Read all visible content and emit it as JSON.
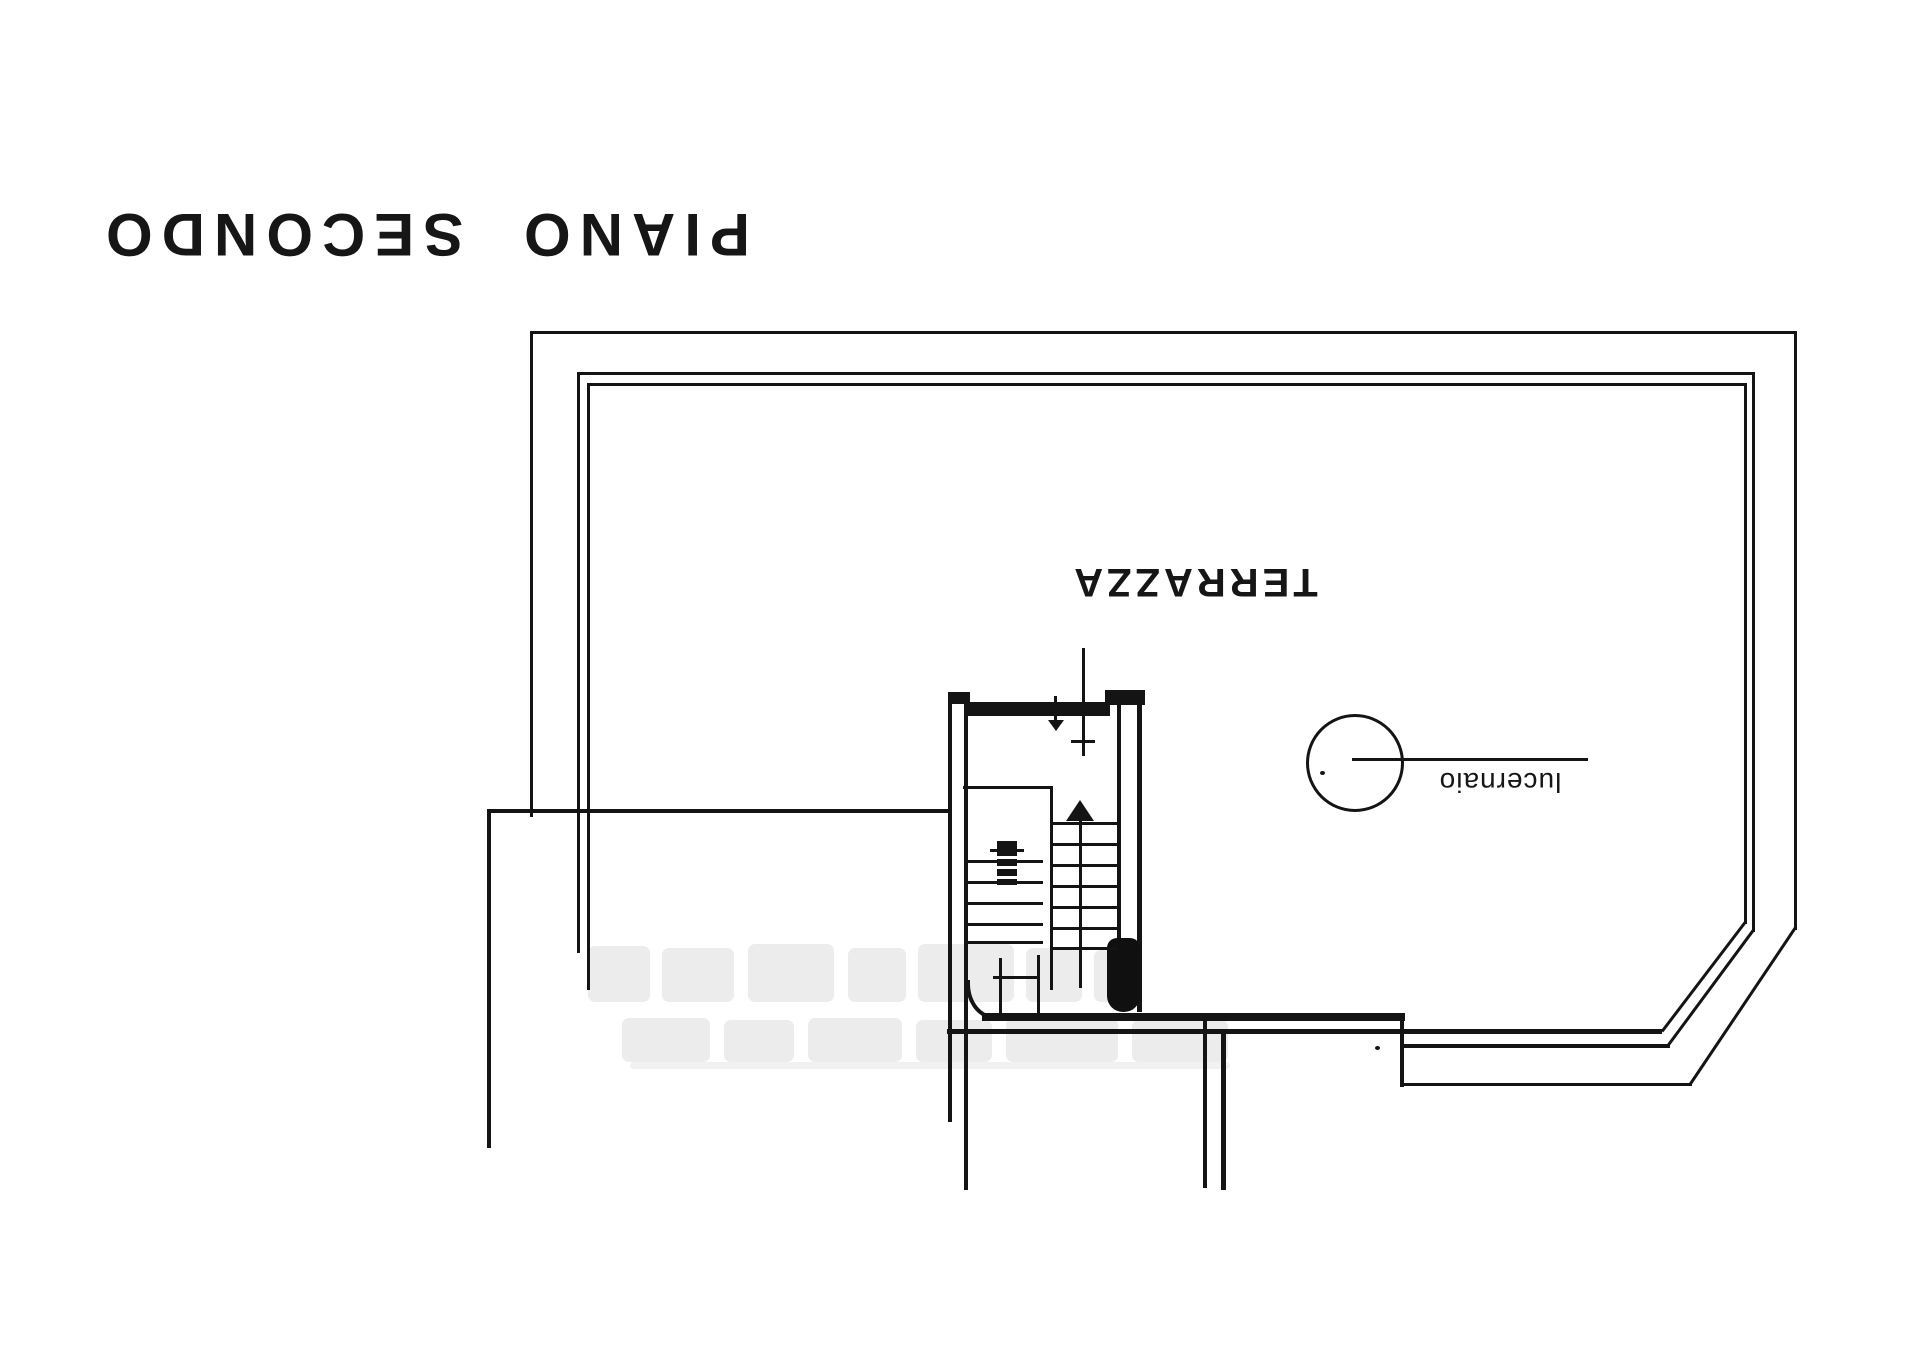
{
  "plan": {
    "title": "PIANO SECONDO",
    "terrace_label": "TERRAZZA",
    "skylight_label": "lucernaio",
    "ink_color": "#141414",
    "background_color": "#ffffff",
    "watermark_color": "#dcdcdc"
  }
}
